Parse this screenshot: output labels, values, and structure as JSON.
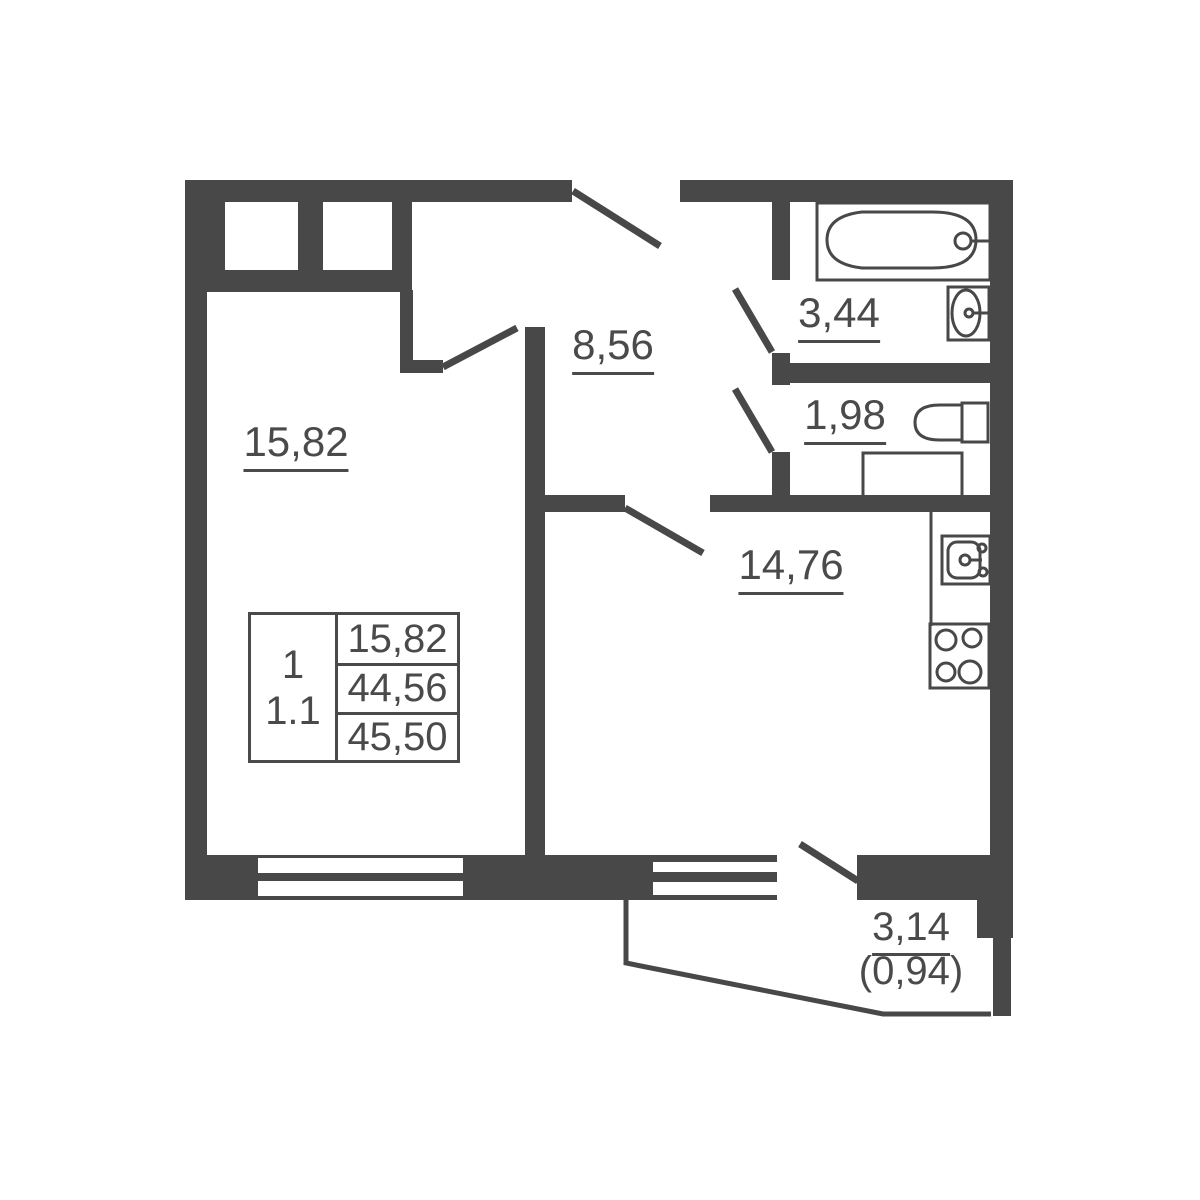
{
  "plan": {
    "title": "apartment-floor-plan",
    "rooms": {
      "living_room": {
        "area": "15,82"
      },
      "hallway": {
        "area": "8,56"
      },
      "bathroom": {
        "area": "3,44"
      },
      "toilet": {
        "area": "1,98"
      },
      "kitchen_living": {
        "area": "14,76"
      },
      "balcony": {
        "area": "3,14",
        "area_coeff": "(0,94)"
      }
    },
    "info_table": {
      "rooms_count": "1",
      "plan_type": "1.1",
      "living_area": "15,82",
      "apartment_area": "44,56",
      "total_area": "45,50"
    },
    "fixtures": [
      "bathtub",
      "washbasin",
      "toilet",
      "washing-machine",
      "kitchen-sink",
      "stove"
    ],
    "colors": {
      "wall": "#484848",
      "background": "#ffffff",
      "text": "#4a4a4a"
    }
  }
}
